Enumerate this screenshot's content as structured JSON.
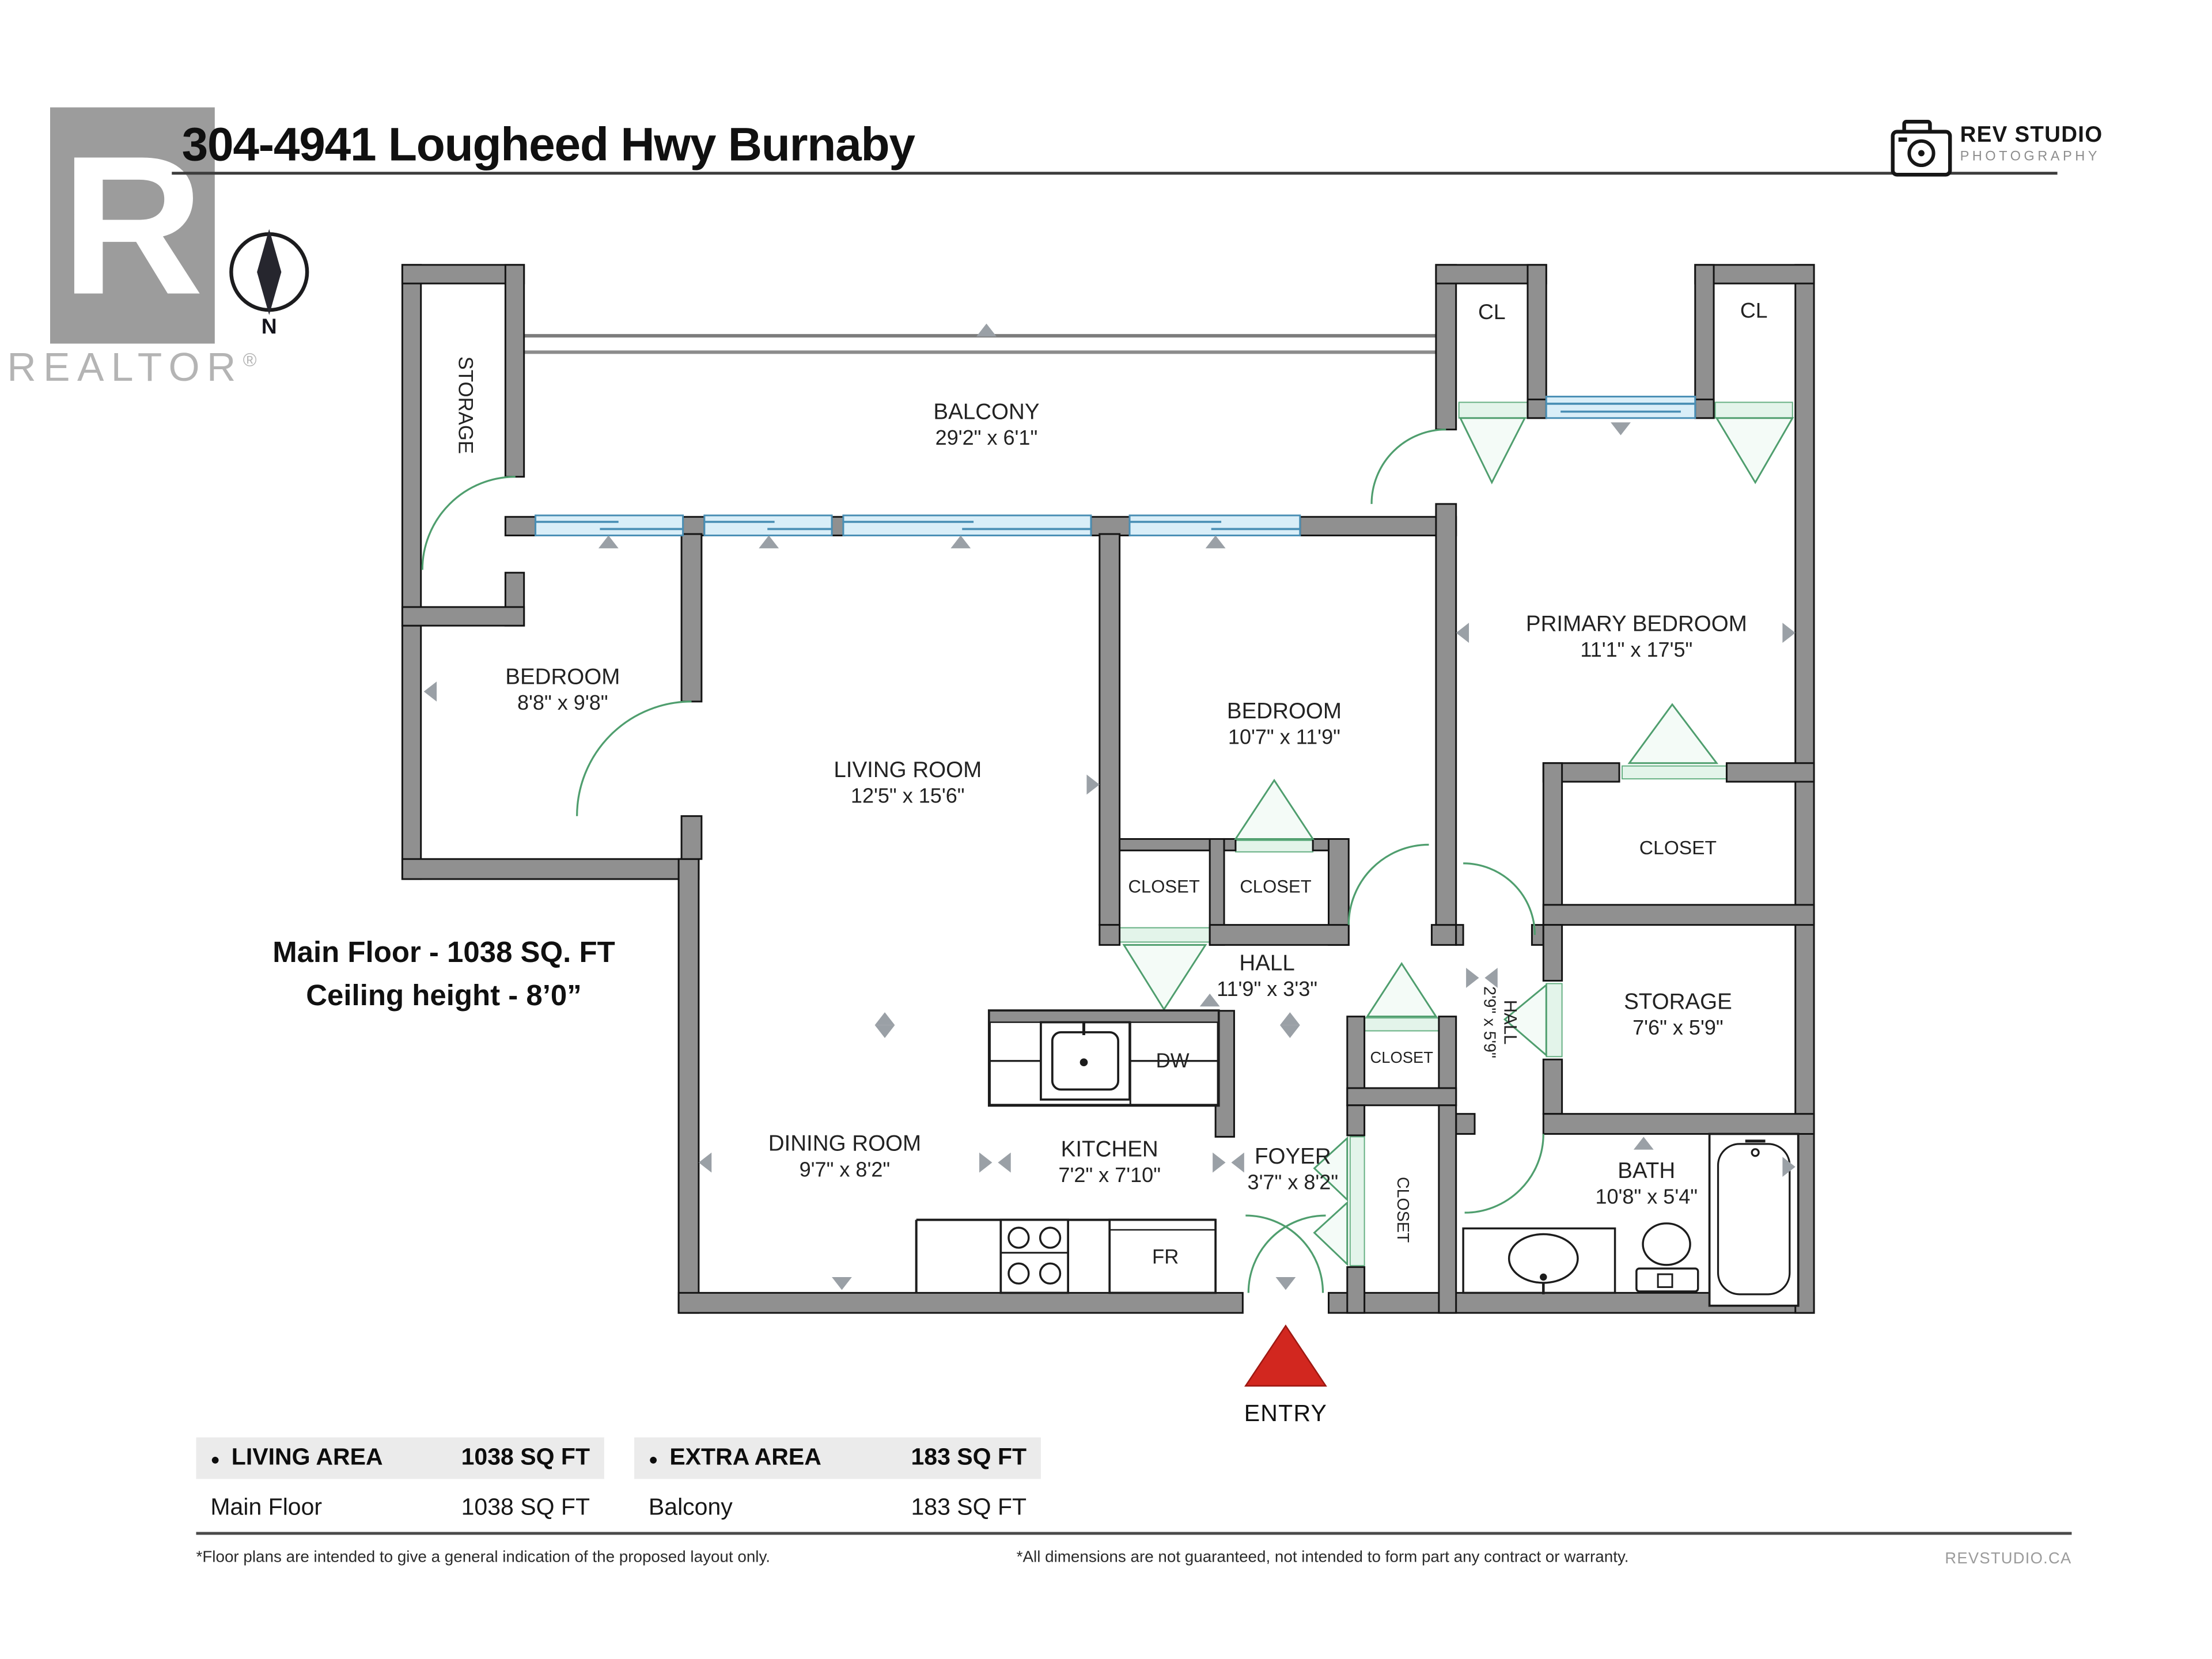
{
  "page": {
    "title": "304-4941 Lougheed Hwy Burnaby",
    "realtor_logo": {
      "letter": "R",
      "label": "REALTOR",
      "reg": "®"
    },
    "compass_label": "N",
    "studio_logo": {
      "line1": "REV STUDIO",
      "line2": "PHOTOGRAPHY"
    },
    "floor_note": {
      "line1": "Main Floor - 1038 SQ. FT",
      "line2": "Ceiling height - 8’0”"
    },
    "entry_label": "ENTRY"
  },
  "plan": {
    "labels": [
      {
        "id": "storage-upper",
        "name": "STORAGE",
        "dims": ""
      },
      {
        "id": "balcony",
        "name": "BALCONY",
        "dims": "29'2\" x 6'1\""
      },
      {
        "id": "cl-left",
        "name": "CL",
        "dims": ""
      },
      {
        "id": "cl-right",
        "name": "CL",
        "dims": ""
      },
      {
        "id": "bedroom-left",
        "name": "BEDROOM",
        "dims": "8'8\" x 9'8\""
      },
      {
        "id": "living-room",
        "name": "LIVING ROOM",
        "dims": "12'5\" x 15'6\""
      },
      {
        "id": "bedroom-middle",
        "name": "BEDROOM",
        "dims": "10'7\" x 11'9\""
      },
      {
        "id": "primary-bedroom",
        "name": "PRIMARY BEDROOM",
        "dims": "11'1\" x 17'5\""
      },
      {
        "id": "closet-a",
        "name": "CLOSET",
        "dims": ""
      },
      {
        "id": "closet-b",
        "name": "CLOSET",
        "dims": ""
      },
      {
        "id": "primary-closet",
        "name": "CLOSET",
        "dims": ""
      },
      {
        "id": "hall-main",
        "name": "HALL",
        "dims": "11'9\" x 3'3\""
      },
      {
        "id": "hall-side",
        "name": "HALL",
        "dims": "2'9\" x 5'9\""
      },
      {
        "id": "storage-lower",
        "name": "STORAGE",
        "dims": "7'6\" x 5'9\""
      },
      {
        "id": "closet-foyer-top",
        "name": "CLOSET",
        "dims": ""
      },
      {
        "id": "closet-foyer-side",
        "name": "CLOSET",
        "dims": ""
      },
      {
        "id": "dining-room",
        "name": "DINING ROOM",
        "dims": "9'7\" x 8'2\""
      },
      {
        "id": "kitchen",
        "name": "KITCHEN",
        "dims": "7'2\" x 7'10\""
      },
      {
        "id": "foyer",
        "name": "FOYER",
        "dims": "3'7\" x 8'2\""
      },
      {
        "id": "bath",
        "name": "BATH",
        "dims": "10'8\" x 5'4\""
      },
      {
        "id": "dw",
        "name": "DW",
        "dims": ""
      },
      {
        "id": "fr",
        "name": "FR",
        "dims": ""
      }
    ],
    "colors": {
      "wall": "#909090",
      "door_green": "#4f9e6e",
      "window_blue": "#4a8fb5",
      "entry_red": "#d2271f",
      "marker_gray": "#9aa0a6"
    }
  },
  "summary_table": {
    "col1": {
      "bullet": "●",
      "header": "LIVING AREA",
      "header_value": "1038 SQ FT",
      "row": "Main Floor",
      "row_value": "1038 SQ FT"
    },
    "col2": {
      "bullet": "●",
      "header": "EXTRA AREA",
      "header_value": "183 SQ FT",
      "row": "Balcony",
      "row_value": "183 SQ FT"
    }
  },
  "footer": {
    "note_left": "*Floor plans are intended to give a general indication of the proposed layout only.",
    "note_right": "*All dimensions are not guaranteed, not intended to form part any contract or warranty.",
    "brand": "REVSTUDIO.CA"
  }
}
